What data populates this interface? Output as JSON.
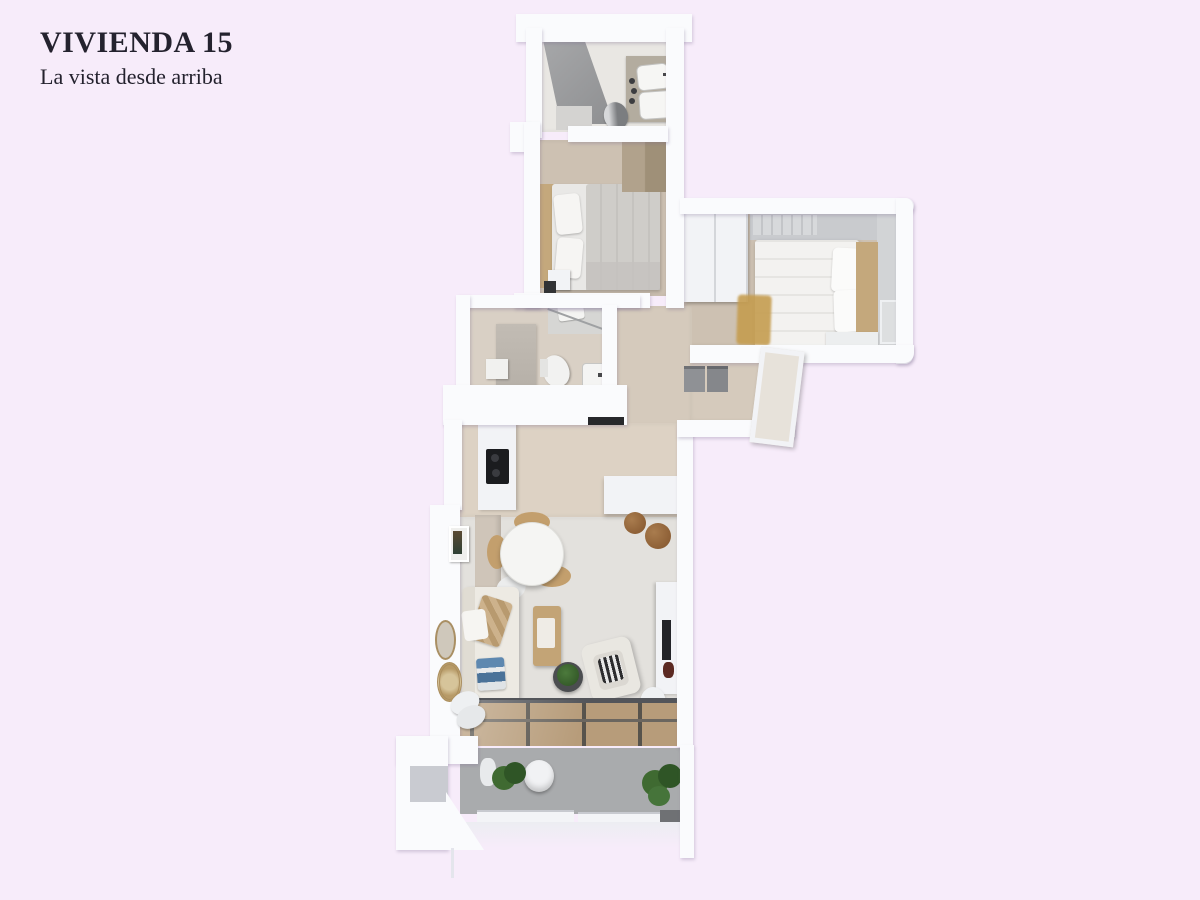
{
  "header": {
    "title": "VIVIENDA 15",
    "subtitle": "La vista desde arriba"
  },
  "colors": {
    "bg": "#f7ecfa",
    "text": "#24222e",
    "wall": "#fafbfd",
    "wallFace": "#c9cbce",
    "parapet": "#ecedf2",
    "floorBeige": "#cdc1b2",
    "floorBeigeLight": "#ddd2c4",
    "floorHall": "#d5cabc",
    "floorBath": "#d9d0c5",
    "floorBathWhite": "#e9e7e3",
    "floorMarble": "#e3e1dd",
    "terrace": "#a9abad",
    "deck": "#b79c7a",
    "deckLine": "#57534c",
    "track": "#53555a",
    "showerA": "#a6a7a9",
    "showerB": "#8e8f91",
    "tan": "#c4a87c",
    "wardrobeTan": "#b1a28c",
    "counterTan": "#b3ac9f",
    "duvetGray": "#cfcdc9",
    "linenWhite": "#f3f2f0",
    "furnWhite": "#f2f3f6",
    "benchWood": "#c3a476",
    "poufBrown": "#a97c4e",
    "poufBrownDark": "#82542c",
    "plantA": "#3f6a31",
    "plantB": "#2f5526",
    "dark": "#1b1c1f",
    "boxGray": "#8f9195",
    "railDark": "#6f7174",
    "rug": "#c59d50",
    "blue": "#4f7ca8",
    "bottleRed": "#5c2a22"
  },
  "floorplan": {
    "view": "3d-top-down-render",
    "rooms": [
      {
        "name": "bathroom-top",
        "furniture": [
          "shower",
          "double-sink-vanity",
          "toilet"
        ]
      },
      {
        "name": "bedroom-small",
        "furniture": [
          "double-bed",
          "pillows",
          "nightstand",
          "wardrobe"
        ]
      },
      {
        "name": "bedroom-master",
        "furniture": [
          "double-bed",
          "pillows",
          "wardrobe",
          "bench",
          "rug",
          "nightstand"
        ]
      },
      {
        "name": "bathroom-middle",
        "furniture": [
          "shower",
          "toilet",
          "sink",
          "cabinet"
        ]
      },
      {
        "name": "hallway",
        "furniture": [
          "storage-boxes",
          "entrance-door"
        ]
      },
      {
        "name": "kitchen-dining",
        "furniture": [
          "kitchen-counter",
          "cooktop",
          "island-counter",
          "round-dining-table",
          "rattan-chairs",
          "poufs",
          "wall-art"
        ]
      },
      {
        "name": "living-room",
        "furniture": [
          "corner-sofa",
          "cushions",
          "coffee-bench",
          "side-table-with-plant",
          "armchair",
          "tv-unit",
          "tv",
          "wall-mirrors",
          "floor-poufs",
          "sliding-glass-door"
        ]
      },
      {
        "name": "terrace",
        "furniture": [
          "plants",
          "stool",
          "vase",
          "railing"
        ]
      }
    ]
  }
}
